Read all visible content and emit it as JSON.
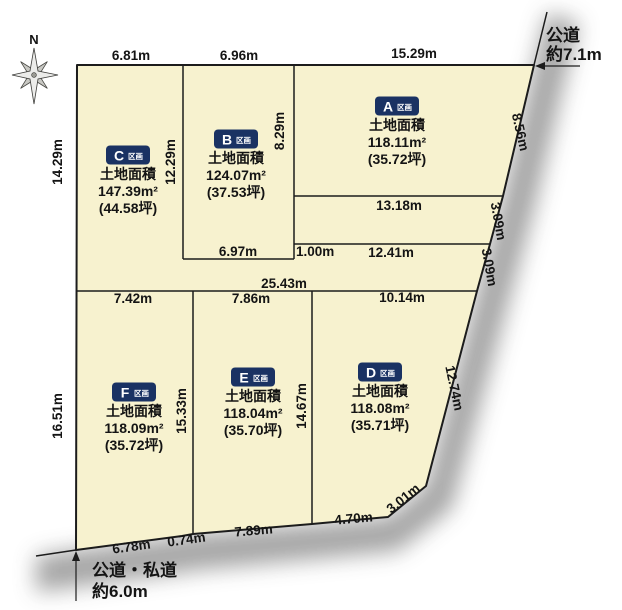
{
  "compass": {
    "north_label": "N"
  },
  "roads": {
    "top_right": {
      "line1": "公道",
      "line2": "約7.1m"
    },
    "bottom_left": {
      "line1": "公道・私道",
      "line2": "約6.0m"
    }
  },
  "plots": {
    "a": {
      "letter": "A",
      "type_label": "区画",
      "title": "土地面積",
      "area_m2": "118.11m²",
      "area_tsubo": "(35.72坪)"
    },
    "b": {
      "letter": "B",
      "type_label": "区画",
      "title": "土地面積",
      "area_m2": "124.07m²",
      "area_tsubo": "(37.53坪)"
    },
    "c": {
      "letter": "C",
      "type_label": "区画",
      "title": "土地面積",
      "area_m2": "147.39m²",
      "area_tsubo": "(44.58坪)"
    },
    "d": {
      "letter": "D",
      "type_label": "区画",
      "title": "土地面積",
      "area_m2": "118.08m²",
      "area_tsubo": "(35.71坪)"
    },
    "e": {
      "letter": "E",
      "type_label": "区画",
      "title": "土地面積",
      "area_m2": "118.04m²",
      "area_tsubo": "(35.70坪)"
    },
    "f": {
      "letter": "F",
      "type_label": "区画",
      "title": "土地面積",
      "area_m2": "118.09m²",
      "area_tsubo": "(35.72坪)"
    }
  },
  "dims": {
    "top_c": "6.81m",
    "top_b": "6.96m",
    "top_a": "15.29m",
    "left_upper": "14.29m",
    "left_lower": "16.51m",
    "divider_cb": "12.29m",
    "divider_ba": "8.29m",
    "a_bottom": "13.18m",
    "line_1241": "12.41m",
    "step": "1.00m",
    "b_bottom": "6.97m",
    "mid_total": "25.43m",
    "f_top": "7.42m",
    "e_top": "7.86m",
    "d_top": "10.14m",
    "divider_fe": "15.33m",
    "divider_ed": "14.67m",
    "slant_1": "8.56m",
    "slant_2": "3.09m",
    "slant_3": "3.09m",
    "slant_4": "12.74m",
    "corner_cut": "3.01m",
    "bottom_f1": "6.78m",
    "bottom_f2": "0.74m",
    "bottom_e": "7.89m",
    "bottom_d": "4.70m"
  },
  "colors": {
    "parcel_fill": "#f7f2cf",
    "boundary_line": "#1c1c1c",
    "badge_bg": "#1a3263",
    "road_shadow": "#9c9c9c"
  }
}
